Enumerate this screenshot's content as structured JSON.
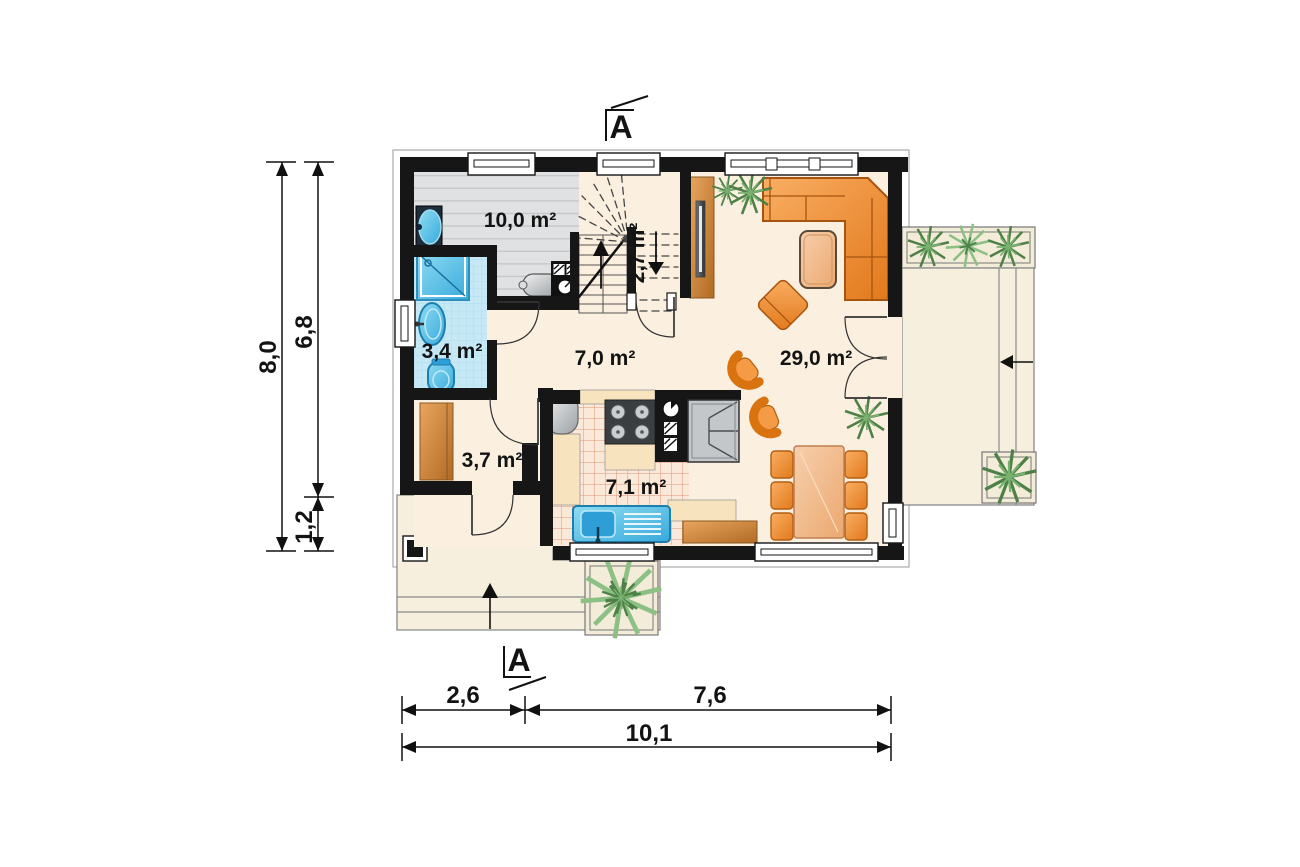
{
  "plan": {
    "title": "house ground-floor plan",
    "rooms": {
      "utility": "10,0 m²",
      "stairwell": "2,7 m²",
      "bathroom": "3,4 m²",
      "hall": "7,0 m²",
      "living": "29,0 m²",
      "vestibule": "3,7 m²",
      "kitchen": "7,1 m²"
    },
    "dims": {
      "h_total": "8,0",
      "h_main": "6,8",
      "h_porch": "1,2",
      "w_left": "2,6",
      "w_right": "7,6",
      "w_total": "10,1"
    },
    "sections": {
      "top": "A",
      "bottom": "A"
    },
    "colors": {
      "wall": "#161616",
      "floor_cream": "#FBF0DF",
      "floor_gray": "#DFE1E2",
      "bathroom_tile": "#C7E9F6",
      "kitchen_tile_line": "#E09578",
      "furniture_orange": "#EE8A33",
      "wood": "#C9813E",
      "fixture_blue": "#5FC9E9",
      "appliance_gray": "#B9BDC0",
      "plant_green": "#6FA96B",
      "terrace": "#F7EFDE"
    }
  }
}
